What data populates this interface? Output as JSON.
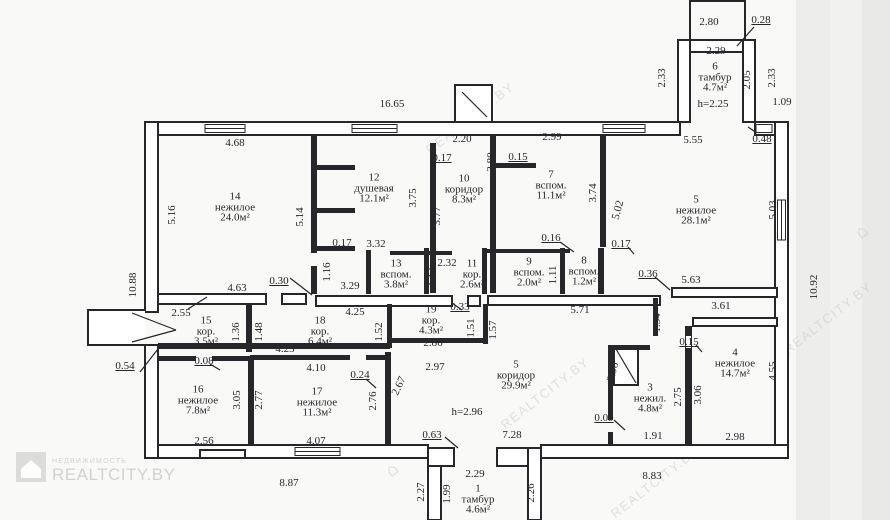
{
  "watermark": {
    "brand": "REALTCITY.BY",
    "tagline": "НЕДВИЖИМОСТЬ",
    "diagonal_text": "REALTCITY.BY",
    "color": "#d2d2cf"
  },
  "colors": {
    "ink": "#26262b",
    "paper": "#f9f9f7"
  },
  "plan": {
    "rooms": [
      {
        "number": "14",
        "name": "нежилое",
        "area": "24.0м²",
        "x": 235,
        "y": 207
      },
      {
        "number": "12",
        "name": "душевая",
        "area": "12.1м²",
        "x": 374,
        "y": 188
      },
      {
        "number": "10",
        "name": "коридор",
        "area": "8.3м²",
        "x": 464,
        "y": 189
      },
      {
        "number": "7",
        "name": "вспом.",
        "area": "11.1м²",
        "x": 551,
        "y": 185
      },
      {
        "number": "5",
        "name": "нежилое",
        "area": "28.1м²",
        "x": 696,
        "y": 210
      },
      {
        "number": "6",
        "name": "тамбур",
        "area": "4.7м²",
        "x": 715,
        "y": 77
      },
      {
        "number": "13",
        "name": "вспом.",
        "area": "3.8м²",
        "x": 396,
        "y": 274
      },
      {
        "number": "11",
        "name": "кор.",
        "area": "2.6м²",
        "x": 472,
        "y": 274
      },
      {
        "number": "9",
        "name": "вспом.",
        "area": "2.0м²",
        "x": 529,
        "y": 272
      },
      {
        "number": "8",
        "name": "вспом.",
        "area": "1.2м²",
        "x": 584,
        "y": 271
      },
      {
        "number": "15",
        "name": "кор.",
        "area": "3.5м²",
        "x": 206,
        "y": 331
      },
      {
        "number": "18",
        "name": "кор.",
        "area": "6.4м²",
        "x": 320,
        "y": 331
      },
      {
        "number": "19",
        "name": "кор.",
        "area": "4.3м²",
        "x": 431,
        "y": 320
      },
      {
        "number": "16",
        "name": "нежилое",
        "area": "7.8м²",
        "x": 198,
        "y": 400
      },
      {
        "number": "17",
        "name": "нежилое",
        "area": "11.3м²",
        "x": 317,
        "y": 402
      },
      {
        "number": "5",
        "name": "коридор",
        "area": "29.9м²",
        "x": 516,
        "y": 375
      },
      {
        "number": "3",
        "name": "нежил.",
        "area": "4.8м²",
        "x": 650,
        "y": 398
      },
      {
        "number": "4",
        "name": "нежилое",
        "area": "14.7м²",
        "x": 735,
        "y": 363
      },
      {
        "number": "1",
        "name": "тамбур",
        "area": "4.6м²",
        "x": 478,
        "y": 499
      }
    ],
    "dimensions": [
      {
        "t": "16.65",
        "x": 392,
        "y": 104
      },
      {
        "t": "4.68",
        "x": 235,
        "y": 143
      },
      {
        "t": "2.20",
        "x": 462,
        "y": 139
      },
      {
        "t": "2.99",
        "x": 552,
        "y": 137
      },
      {
        "t": "0.17",
        "x": 442,
        "y": 158,
        "u": true
      },
      {
        "t": "0.15",
        "x": 518,
        "y": 157,
        "u": true
      },
      {
        "t": "2.80",
        "x": 709,
        "y": 22
      },
      {
        "t": "0.28",
        "x": 761,
        "y": 20,
        "u": true
      },
      {
        "t": "2.29",
        "x": 716,
        "y": 51
      },
      {
        "t": "h=2.25",
        "x": 713,
        "y": 104
      },
      {
        "t": "1.09",
        "x": 782,
        "y": 102
      },
      {
        "t": "5.55",
        "x": 693,
        "y": 140
      },
      {
        "t": "0.48",
        "x": 762,
        "y": 139,
        "u": true
      },
      {
        "t": "0.17",
        "x": 342,
        "y": 243,
        "u": true
      },
      {
        "t": "3.32",
        "x": 376,
        "y": 244
      },
      {
        "t": "0.16",
        "x": 551,
        "y": 238,
        "u": true
      },
      {
        "t": "0.17",
        "x": 621,
        "y": 244,
        "u": true
      },
      {
        "t": "2.32",
        "x": 447,
        "y": 263
      },
      {
        "t": "0.30",
        "x": 279,
        "y": 281,
        "u": true
      },
      {
        "t": "4.63",
        "x": 237,
        "y": 288
      },
      {
        "t": "3.29",
        "x": 350,
        "y": 286
      },
      {
        "t": "0.36",
        "x": 648,
        "y": 274,
        "u": true
      },
      {
        "t": "5.63",
        "x": 691,
        "y": 280
      },
      {
        "t": "3.61",
        "x": 721,
        "y": 306
      },
      {
        "t": "2.55",
        "x": 181,
        "y": 313
      },
      {
        "t": "4.25",
        "x": 355,
        "y": 312
      },
      {
        "t": "0.33",
        "x": 460,
        "y": 307,
        "u": true
      },
      {
        "t": "5.71",
        "x": 580,
        "y": 310
      },
      {
        "t": "2.86",
        "x": 433,
        "y": 343
      },
      {
        "t": "4.23",
        "x": 285,
        "y": 349
      },
      {
        "t": "0.08",
        "x": 204,
        "y": 361,
        "u": true
      },
      {
        "t": "0.54",
        "x": 125,
        "y": 366,
        "u": true
      },
      {
        "t": "4.10",
        "x": 316,
        "y": 368
      },
      {
        "t": "0.24",
        "x": 360,
        "y": 375,
        "u": true
      },
      {
        "t": "2.97",
        "x": 435,
        "y": 367
      },
      {
        "t": "h=2.96",
        "x": 467,
        "y": 412
      },
      {
        "t": "0.09",
        "x": 604,
        "y": 418,
        "u": true
      },
      {
        "t": "1.91",
        "x": 653,
        "y": 436
      },
      {
        "t": "2.98",
        "x": 735,
        "y": 437
      },
      {
        "t": "2.56",
        "x": 204,
        "y": 441
      },
      {
        "t": "4.07",
        "x": 316,
        "y": 441
      },
      {
        "t": "0.63",
        "x": 432,
        "y": 435,
        "u": true
      },
      {
        "t": "7.28",
        "x": 512,
        "y": 435
      },
      {
        "t": "0.15",
        "x": 689,
        "y": 342,
        "u": true
      },
      {
        "t": "8.87",
        "x": 289,
        "y": 483
      },
      {
        "t": "8.83",
        "x": 652,
        "y": 476
      },
      {
        "t": "2.29",
        "x": 475,
        "y": 474
      },
      {
        "t": "5.16",
        "x": 172,
        "y": 215,
        "r": -90
      },
      {
        "t": "5.14",
        "x": 300,
        "y": 217,
        "r": -90
      },
      {
        "t": "3.75",
        "x": 413,
        "y": 198,
        "r": -90
      },
      {
        "t": "3.77",
        "x": 437,
        "y": 216,
        "r": -90
      },
      {
        "t": "3.80",
        "x": 491,
        "y": 162,
        "r": -90
      },
      {
        "t": "3.74",
        "x": 593,
        "y": 193,
        "r": -90
      },
      {
        "t": "5.02",
        "x": 618,
        "y": 210,
        "r": -75
      },
      {
        "t": "2.33",
        "x": 662,
        "y": 78,
        "r": -90
      },
      {
        "t": "2.05",
        "x": 747,
        "y": 80,
        "r": -90
      },
      {
        "t": "2.33",
        "x": 772,
        "y": 78,
        "r": -90
      },
      {
        "t": "5.03",
        "x": 773,
        "y": 210,
        "r": -90
      },
      {
        "t": "10.88",
        "x": 133,
        "y": 285,
        "r": -90
      },
      {
        "t": "1.16",
        "x": 327,
        "y": 272,
        "r": -90
      },
      {
        "t": "1.14",
        "x": 433,
        "y": 277,
        "r": -90
      },
      {
        "t": "1.11",
        "x": 553,
        "y": 275,
        "r": -90
      },
      {
        "t": "10.92",
        "x": 814,
        "y": 287,
        "r": -90
      },
      {
        "t": "1.36",
        "x": 236,
        "y": 332,
        "r": -90
      },
      {
        "t": "1.48",
        "x": 259,
        "y": 332,
        "r": -90
      },
      {
        "t": "1.52",
        "x": 379,
        "y": 332,
        "r": -90
      },
      {
        "t": "1.51",
        "x": 471,
        "y": 328,
        "r": -90
      },
      {
        "t": "1.57",
        "x": 493,
        "y": 330,
        "r": -90
      },
      {
        "t": "1.54",
        "x": 657,
        "y": 323,
        "r": -90
      },
      {
        "t": "3.05",
        "x": 237,
        "y": 400,
        "r": -90
      },
      {
        "t": "2.77",
        "x": 259,
        "y": 400,
        "r": -90
      },
      {
        "t": "2.76",
        "x": 373,
        "y": 401,
        "r": -90
      },
      {
        "t": "2.67",
        "x": 399,
        "y": 386,
        "r": -65
      },
      {
        "t": "2.96",
        "x": 613,
        "y": 372,
        "r": -75
      },
      {
        "t": "2.75",
        "x": 678,
        "y": 397,
        "r": -90
      },
      {
        "t": "3.06",
        "x": 698,
        "y": 395,
        "r": -90
      },
      {
        "t": "4.55",
        "x": 773,
        "y": 371,
        "r": -90
      },
      {
        "t": "2.27",
        "x": 421,
        "y": 492,
        "r": -90
      },
      {
        "t": "1.99",
        "x": 447,
        "y": 494,
        "r": -90
      },
      {
        "t": "2.26",
        "x": 531,
        "y": 493,
        "r": -90
      }
    ]
  }
}
